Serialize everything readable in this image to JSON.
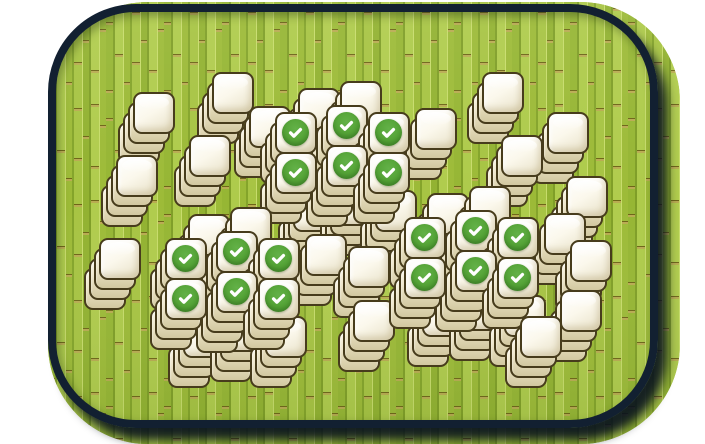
{
  "scene": {
    "type": "mahjong-solitaire-board",
    "matched_check_count": 18,
    "total_tile_stacks": 51
  },
  "board": {
    "left": 48,
    "top": 4,
    "ring_width": 610,
    "ring_height": 424,
    "ring_border": 8,
    "ring_radius": 88,
    "bg_left": 48,
    "bg_top": 2,
    "bg_width": 632,
    "bg_height": 442,
    "bg_radius": 100
  },
  "tile": {
    "face_w": 42,
    "face_h": 42,
    "radius": 9,
    "layer_dx": -5,
    "layer_dy": 10
  },
  "check": {
    "size": 27,
    "icon": "checkmark"
  },
  "colors": {
    "page_bg": "#ffffff",
    "ring_navy": "#122031",
    "shadow_navy": "#08111e",
    "bamboo_base": "#a3c040",
    "bamboo_dark": "#7f9e27",
    "bamboo_light": "#c7dc6b",
    "bamboo_joint": "#b9ab52",
    "tile_border": "#473c1c",
    "tile_face_light": "#ffffff",
    "tile_face_dark": "#e7e0c6",
    "tile_side": "#d2c8a0",
    "check_green": "#54a336",
    "check_mark": "#ffffff"
  },
  "stacks": [
    {
      "group": "chain-top-left",
      "x": 212,
      "y": 72,
      "layers": 3,
      "check": false
    },
    {
      "group": "chain-top-left",
      "x": 133,
      "y": 92,
      "layers": 3,
      "check": false
    },
    {
      "group": "chain-top-left",
      "x": 189,
      "y": 135,
      "layers": 3,
      "check": false
    },
    {
      "group": "chain-top-left",
      "x": 116,
      "y": 155,
      "layers": 3,
      "check": false
    },
    {
      "group": "chain-top-right",
      "x": 482,
      "y": 72,
      "layers": 3,
      "check": false
    },
    {
      "group": "chain-top-right",
      "x": 547,
      "y": 112,
      "layers": 3,
      "check": false
    },
    {
      "group": "chain-top-right",
      "x": 501,
      "y": 135,
      "layers": 3,
      "check": false
    },
    {
      "group": "cluster-top",
      "x": 298,
      "y": 88,
      "layers": 2,
      "check": false
    },
    {
      "group": "cluster-top",
      "x": 340,
      "y": 81,
      "layers": 2,
      "check": false
    },
    {
      "group": "cluster-top",
      "x": 249,
      "y": 106,
      "layers": 3,
      "check": false
    },
    {
      "group": "cluster-top",
      "x": 415,
      "y": 108,
      "layers": 3,
      "check": false
    },
    {
      "group": "cluster-top",
      "x": 293,
      "y": 190,
      "layers": 3,
      "check": false
    },
    {
      "group": "cluster-top",
      "x": 335,
      "y": 184,
      "layers": 3,
      "check": false
    },
    {
      "group": "cluster-top",
      "x": 375,
      "y": 190,
      "layers": 3,
      "check": false
    },
    {
      "group": "cluster-top",
      "x": 326,
      "y": 105,
      "layers": 4,
      "check": true
    },
    {
      "group": "cluster-top",
      "x": 275,
      "y": 112,
      "layers": 3,
      "check": true
    },
    {
      "group": "cluster-top",
      "x": 368,
      "y": 112,
      "layers": 3,
      "check": true
    },
    {
      "group": "cluster-top",
      "x": 326,
      "y": 145,
      "layers": 4,
      "check": true
    },
    {
      "group": "cluster-top",
      "x": 275,
      "y": 152,
      "layers": 3,
      "check": true
    },
    {
      "group": "cluster-top",
      "x": 368,
      "y": 152,
      "layers": 3,
      "check": true
    },
    {
      "group": "chain-right",
      "x": 566,
      "y": 176,
      "layers": 3,
      "check": false
    },
    {
      "group": "lone-left",
      "x": 99,
      "y": 238,
      "layers": 3,
      "check": false
    },
    {
      "group": "cluster-bottom-left",
      "x": 188,
      "y": 214,
      "layers": 2,
      "check": false
    },
    {
      "group": "cluster-bottom-left",
      "x": 230,
      "y": 207,
      "layers": 2,
      "check": false
    },
    {
      "group": "cluster-bottom-left",
      "x": 305,
      "y": 234,
      "layers": 3,
      "check": false
    },
    {
      "group": "cluster-bottom-left",
      "x": 183,
      "y": 316,
      "layers": 3,
      "check": false
    },
    {
      "group": "cluster-bottom-left",
      "x": 225,
      "y": 310,
      "layers": 3,
      "check": false
    },
    {
      "group": "cluster-bottom-left",
      "x": 265,
      "y": 316,
      "layers": 3,
      "check": false
    },
    {
      "group": "cluster-bottom-left",
      "x": 216,
      "y": 231,
      "layers": 4,
      "check": true
    },
    {
      "group": "cluster-bottom-left",
      "x": 165,
      "y": 238,
      "layers": 3,
      "check": true
    },
    {
      "group": "cluster-bottom-left",
      "x": 258,
      "y": 238,
      "layers": 3,
      "check": true
    },
    {
      "group": "cluster-bottom-left",
      "x": 216,
      "y": 271,
      "layers": 4,
      "check": true
    },
    {
      "group": "cluster-bottom-left",
      "x": 165,
      "y": 278,
      "layers": 3,
      "check": true
    },
    {
      "group": "cluster-bottom-left",
      "x": 258,
      "y": 278,
      "layers": 3,
      "check": true
    },
    {
      "group": "chain-middle",
      "x": 348,
      "y": 246,
      "layers": 3,
      "check": false
    },
    {
      "group": "chain-middle",
      "x": 353,
      "y": 300,
      "layers": 3,
      "check": false
    },
    {
      "group": "cluster-bottom-right",
      "x": 427,
      "y": 193,
      "layers": 2,
      "check": false
    },
    {
      "group": "cluster-bottom-right",
      "x": 469,
      "y": 186,
      "layers": 2,
      "check": false
    },
    {
      "group": "cluster-bottom-right",
      "x": 544,
      "y": 213,
      "layers": 3,
      "check": false
    },
    {
      "group": "cluster-bottom-right",
      "x": 422,
      "y": 295,
      "layers": 3,
      "check": false
    },
    {
      "group": "cluster-bottom-right",
      "x": 464,
      "y": 289,
      "layers": 3,
      "check": false
    },
    {
      "group": "cluster-bottom-right",
      "x": 504,
      "y": 295,
      "layers": 3,
      "check": false
    },
    {
      "group": "cluster-bottom-right",
      "x": 455,
      "y": 210,
      "layers": 4,
      "check": true
    },
    {
      "group": "cluster-bottom-right",
      "x": 404,
      "y": 217,
      "layers": 3,
      "check": true
    },
    {
      "group": "cluster-bottom-right",
      "x": 497,
      "y": 217,
      "layers": 3,
      "check": true
    },
    {
      "group": "cluster-bottom-right",
      "x": 455,
      "y": 250,
      "layers": 4,
      "check": true
    },
    {
      "group": "cluster-bottom-right",
      "x": 404,
      "y": 257,
      "layers": 3,
      "check": true
    },
    {
      "group": "cluster-bottom-right",
      "x": 497,
      "y": 257,
      "layers": 3,
      "check": true
    },
    {
      "group": "chain-right",
      "x": 570,
      "y": 240,
      "layers": 3,
      "check": false
    },
    {
      "group": "chain-right",
      "x": 560,
      "y": 290,
      "layers": 3,
      "check": false
    },
    {
      "group": "chain-right",
      "x": 520,
      "y": 316,
      "layers": 3,
      "check": false
    }
  ]
}
